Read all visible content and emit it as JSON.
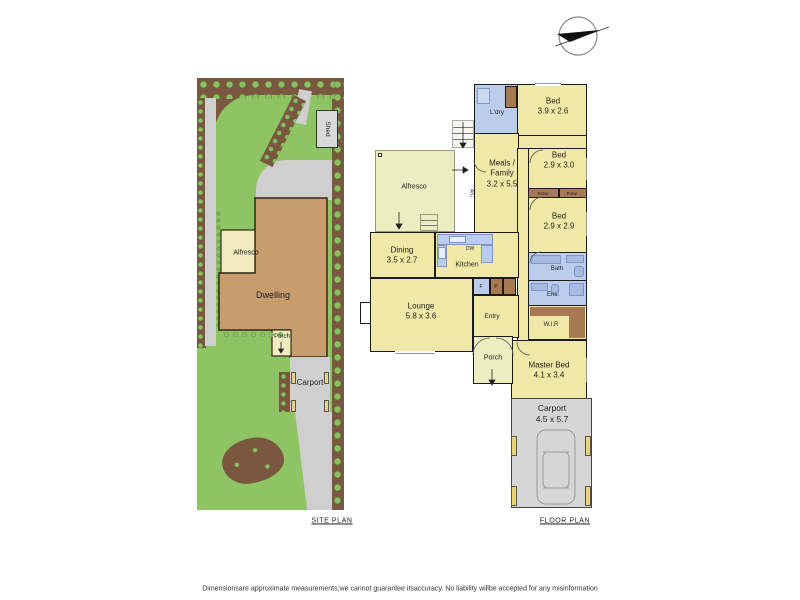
{
  "site_plan": {
    "title": "SITE PLAN",
    "shed": "Shed",
    "alfresco": "Alfresco",
    "dwelling": "Dwelling",
    "porch": "Porch",
    "carport": "Carport"
  },
  "floor_plan": {
    "title": "FLOOR PLAN",
    "laundry": "L'dry",
    "bed1_name": "Bed",
    "bed1_dims": "3.9 x 2.6",
    "meals_line1": "Meals /",
    "meals_line2": "Family",
    "meals_dims": "3.2 x 5.5",
    "bed2_name": "Bed",
    "bed2_dims": "2.9 x 3.0",
    "bed3_name": "Bed",
    "bed3_dims": "2.9 x 2.9",
    "robe1": "Robe",
    "robe2": "Robe",
    "kitchen": "Kitchen",
    "dw": "DW",
    "dining_name": "Dining",
    "dining_dims": "3.5 x 2.7",
    "lounge_name": "Lounge",
    "lounge_dims": "5.8 x 3.6",
    "entry": "Entry",
    "bath": "Bath",
    "ens": "Ens.",
    "wir": "W.I.R",
    "master_name": "Master Bed",
    "master_dims": "4.1 x 3.4",
    "porch": "Porch",
    "alfresco": "Alfresco",
    "carport_name": "Carport",
    "carport_dims": "4.5 x 5.7",
    "ac": "A/C",
    "fridge": "F",
    "pantry": "P"
  },
  "footer": {
    "disclaimer": "Dimensionsare approximate measurements;we cannot guarantee itsaccuracy.  No liability willbe accepted  for any misinformation"
  }
}
